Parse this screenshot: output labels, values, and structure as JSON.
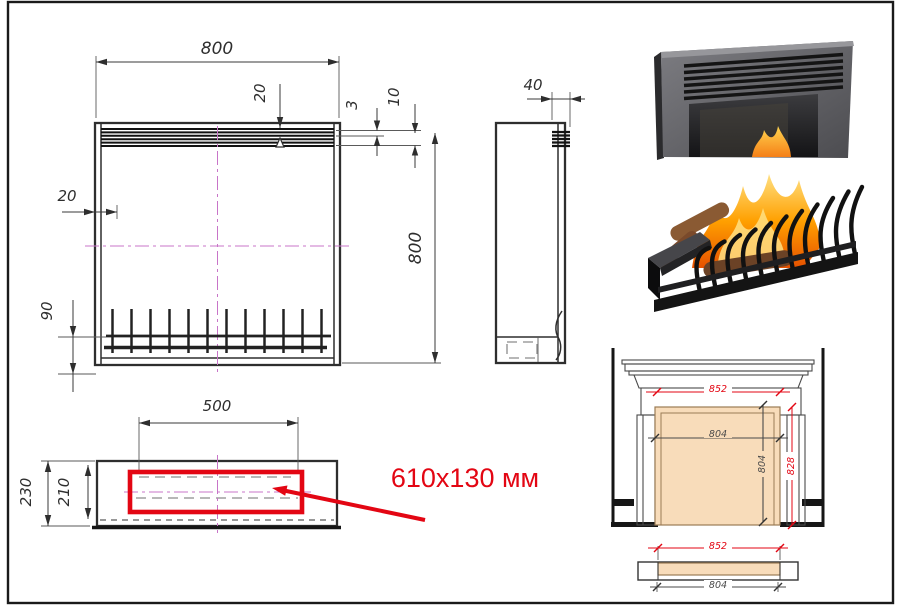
{
  "annotation": {
    "label": "610x130 мм",
    "color": "#e30613"
  },
  "front_view": {
    "width": "800",
    "height": "800",
    "grille_inset": "20",
    "side_inset": "20",
    "slot_gap": "3",
    "grille_band": "10",
    "grate_height": "90"
  },
  "side_view": {
    "depth": "40"
  },
  "bottom_view": {
    "burner_width": "500",
    "depth": "230",
    "inner_depth": "210"
  },
  "portal": {
    "outer_width": "852",
    "opening_width": "804",
    "opening_height": "804",
    "niche_height": "828",
    "plan_outer_width": "852",
    "plan_inner_width": "804"
  },
  "colors": {
    "drawing_line": "#2e2e2e",
    "centerline": "#c874c8",
    "highlight_red": "#e30613",
    "insert_fill_beige": "#f8dcba"
  }
}
